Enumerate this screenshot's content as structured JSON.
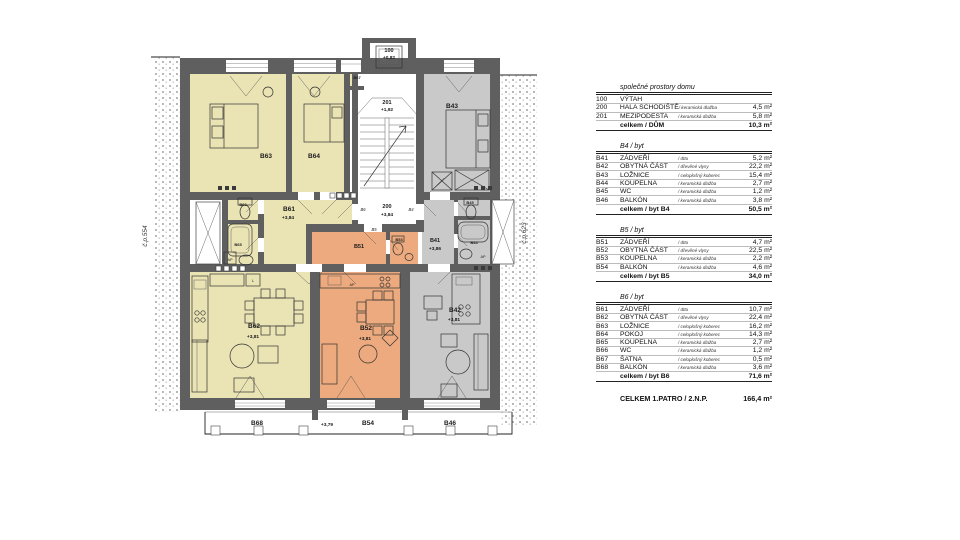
{
  "plan": {
    "neighbor_left": "č.p.554",
    "neighbor_right": "č.p.623",
    "rooms": {
      "elevator": {
        "code": "100",
        "elev": "+0,82"
      },
      "landing": {
        "code": "201",
        "elev": "+1,92"
      },
      "hall": {
        "code": "200",
        "elev": "+3,84"
      },
      "b41": {
        "code": "B41",
        "elev": "+3,86"
      },
      "b42": {
        "code": "B42",
        "elev": "+3,81"
      },
      "b43": "B43",
      "b44": "B44",
      "b45": "B45",
      "b51": "B51",
      "b53": "B53",
      "b52": {
        "code": "B52",
        "elev": "+3,81"
      },
      "b61": {
        "code": "B61",
        "elev": "+3,84"
      },
      "b62": {
        "code": "B62",
        "elev": "+3,81"
      },
      "b63": "B63",
      "b64": "B64",
      "b65": "B65",
      "b66": "B66",
      "b67": "B67",
      "balcony_b68": "B68",
      "balcony_b54": "B54",
      "balcony_b46": "B46",
      "balcony_elev": "+3,79"
    },
    "door_tags": {
      "b4": "B4",
      "b5": "B5",
      "b6": "B6"
    },
    "tags": {
      "washer": "AP",
      "fridge": "L"
    },
    "colors": {
      "flat_b6": "#eae3b4",
      "flat_b5": "#ecaa7e",
      "flat_b4": "#c9c9c9",
      "wall": "#5f5f5f"
    }
  },
  "legend": {
    "tables": [
      {
        "title": "společné prostory domu",
        "rows": [
          {
            "code": "100",
            "name": "VÝTAH",
            "floor": "",
            "area": ""
          },
          {
            "code": "200",
            "name": "HALA SCHODIŠTĚ",
            "floor": "/ keramická dlažba",
            "area": "4,5 m²"
          },
          {
            "code": "201",
            "name": "MEZIPODESTA",
            "floor": "/ keramická dlažba",
            "area": "5,8 m²"
          }
        ],
        "total_label": "celkem / DŮM",
        "total_area": "10,3 m²"
      },
      {
        "title": "B4 / byt",
        "rows": [
          {
            "code": "B41",
            "name": "ZÁDVEŘÍ",
            "floor": "/ dtto",
            "area": "5,2 m²"
          },
          {
            "code": "B42",
            "name": "OBYTNÁ ČÁST",
            "floor": "/ dřevěné vlysy",
            "area": "22,2 m²"
          },
          {
            "code": "B43",
            "name": "LOŽNICE",
            "floor": "/ celoplošný koberec",
            "area": "15,4 m²"
          },
          {
            "code": "B44",
            "name": "KOUPELNA",
            "floor": "/ keramická dlažba",
            "area": "2,7 m²"
          },
          {
            "code": "B45",
            "name": "WC",
            "floor": "/ keramická dlažba",
            "area": "1,2 m²"
          },
          {
            "code": "B46",
            "name": "BALKÓN",
            "floor": "/ keramická dlažba",
            "area": "3,8 m²"
          }
        ],
        "total_label": "celkem / byt B4",
        "total_area": "50,5 m²"
      },
      {
        "title": "B5 / byt",
        "rows": [
          {
            "code": "B51",
            "name": "ZÁDVEŘÍ",
            "floor": "/ dtto",
            "area": "4,7 m²"
          },
          {
            "code": "B52",
            "name": "OBYTNÁ ČÁST",
            "floor": "/ dřevěné vlysy",
            "area": "22,5 m²"
          },
          {
            "code": "B53",
            "name": "KOUPELNA",
            "floor": "/ keramická dlažba",
            "area": "2,2 m²"
          },
          {
            "code": "B54",
            "name": "BALKÓN",
            "floor": "/ keramická dlažba",
            "area": "4,6 m²"
          }
        ],
        "total_label": "celkem / byt B5",
        "total_area": "34,0 m²"
      },
      {
        "title": "B6 / byt",
        "rows": [
          {
            "code": "B61",
            "name": "ZÁDVEŘÍ",
            "floor": "/ dtto",
            "area": "10,7 m²"
          },
          {
            "code": "B62",
            "name": "OBYTNÁ ČÁST",
            "floor": "/ dřevěné vlysy",
            "area": "22,4 m²"
          },
          {
            "code": "B63",
            "name": "LOŽNICE",
            "floor": "/ celoplošný koberec",
            "area": "16,2 m²"
          },
          {
            "code": "B64",
            "name": "POKOJ",
            "floor": "/ celoplošný koberec",
            "area": "14,3 m²"
          },
          {
            "code": "B65",
            "name": "KOUPELNA",
            "floor": "/ keramická dlažba",
            "area": "2,7 m²"
          },
          {
            "code": "B66",
            "name": "WC",
            "floor": "/ keramická dlažba",
            "area": "1,2 m²"
          },
          {
            "code": "B67",
            "name": "ŠATNA",
            "floor": "/ celoplošný koberec",
            "area": "0,5 m²"
          },
          {
            "code": "B68",
            "name": "BALKÓN",
            "floor": "/ keramická dlažba",
            "area": "3,6 m²"
          }
        ],
        "total_label": "celkem / byt B6",
        "total_area": "71,6 m²"
      }
    ],
    "grand_total": {
      "label": "CELKEM 1.PATRO / 2.N.P.",
      "area": "166,4 m²"
    }
  }
}
